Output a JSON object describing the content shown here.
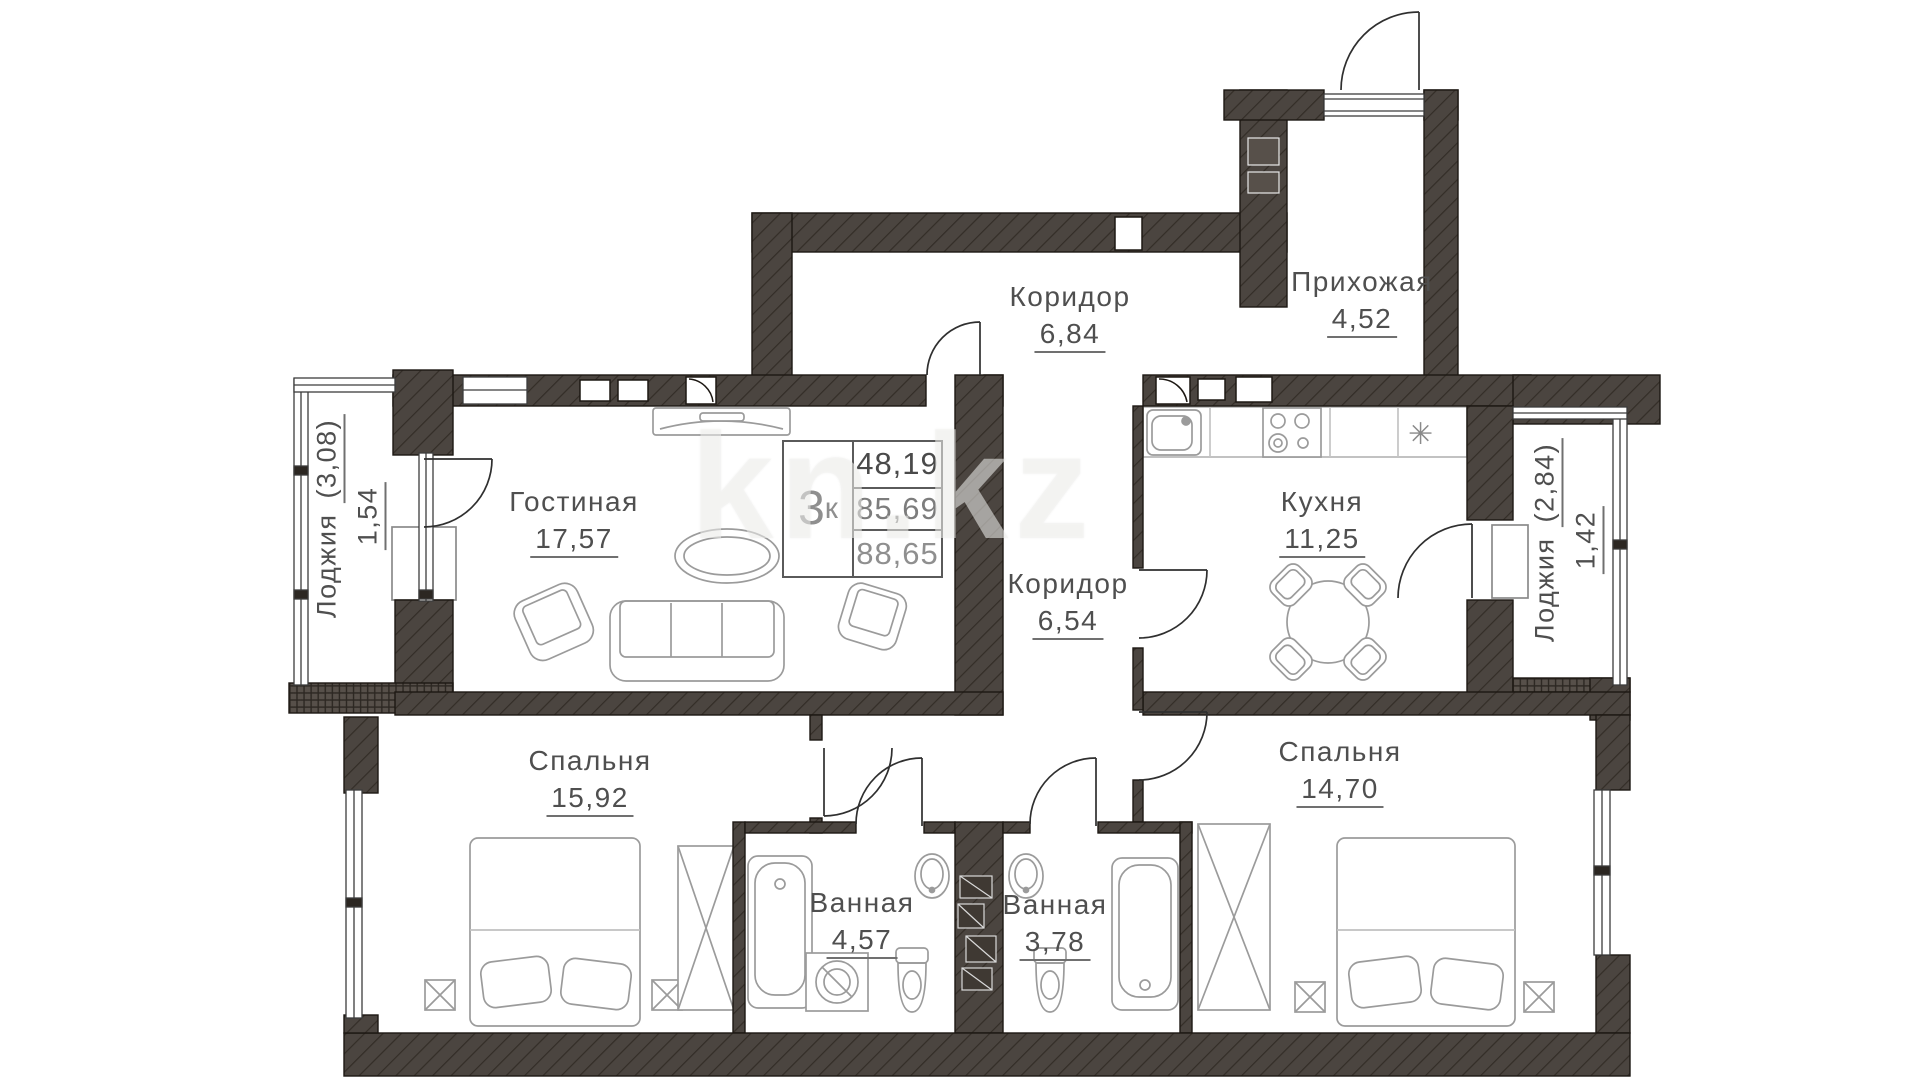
{
  "plan": {
    "watermark": "kn.kz",
    "unit": {
      "rooms_count": "3",
      "rooms_suffix": "к",
      "living_area": "48,19",
      "total_area": "85,69",
      "total_area_with_loggia": "88,65"
    },
    "rooms": {
      "corridor_top": {
        "name": "Коридор",
        "area": "6,84"
      },
      "hallway": {
        "name": "Прихожая",
        "area": "4,52"
      },
      "living": {
        "name": "Гостиная",
        "area": "17,57"
      },
      "corridor_inner": {
        "name": "Коридор",
        "area": "6,54"
      },
      "kitchen": {
        "name": "Кухня",
        "area": "11,25"
      },
      "bedroom_left": {
        "name": "Спальня",
        "area": "15,92"
      },
      "bedroom_right": {
        "name": "Спальня",
        "area": "14,70"
      },
      "bathroom_left": {
        "name": "Ванная",
        "area": "4,57"
      },
      "bathroom_right": {
        "name": "Ванная",
        "area": "3,78"
      },
      "loggia_left": {
        "name": "Лоджия",
        "gross": "(3,08)",
        "area": "1,54"
      },
      "loggia_right": {
        "name": "Лоджия",
        "gross": "(2,84)",
        "area": "1,42"
      }
    },
    "colors": {
      "wall_fill": "#4b4540",
      "hatch_line": "#332d27",
      "line_dark": "#2f2f2f",
      "furniture": "#9b9b9b",
      "text": "#4f4f4f"
    }
  }
}
